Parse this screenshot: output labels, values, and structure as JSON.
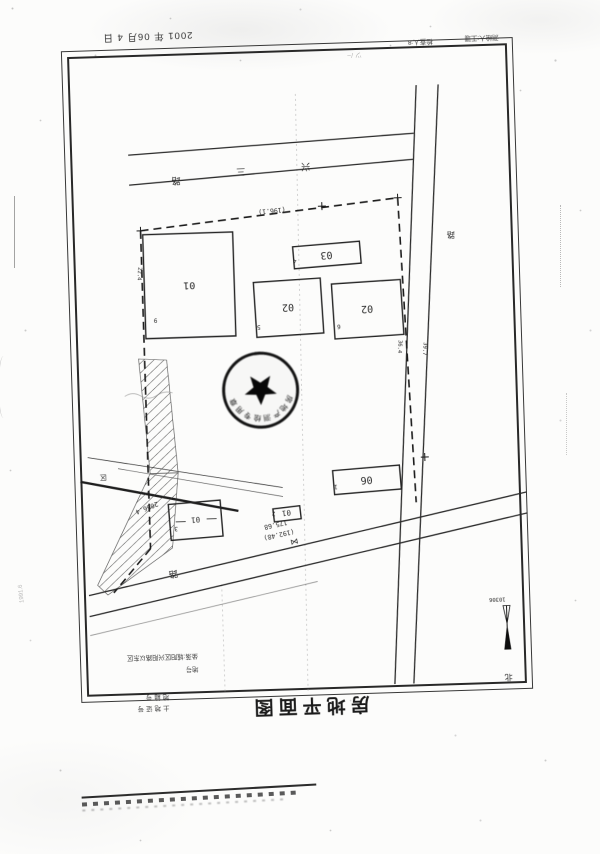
{
  "document": {
    "date_stamp": "2001 年 06月 4 日",
    "checker": "检查人:8",
    "surveyor": "测绘人:王珊",
    "title": "房地平面图",
    "corner_line1": "地籍号",
    "corner_line2": "土地证号",
    "pencil_note_left": "1991.6",
    "pencil_marks_top": "ツ /~"
  },
  "plan": {
    "roads": {
      "top_road_chars": [
        "路",
        "三",
        "兴"
      ],
      "bottom_road_char": "路",
      "side_road_char": "路",
      "road_width_dims": [
        "36.4",
        "39.7"
      ]
    },
    "buildings": [
      {
        "id": "01",
        "point": "9"
      },
      {
        "id": "02",
        "point": "5"
      },
      {
        "id": "02",
        "point": "6"
      },
      {
        "id": "03",
        "point": "4"
      },
      {
        "id": "06",
        "point": "1"
      },
      {
        "id": "01",
        "point": "2"
      },
      {
        "id": "01",
        "point": "3"
      }
    ],
    "dimensions": {
      "north_boundary": "(196.1)",
      "south_frontage": "175.68",
      "south_frontage_alt": "(192.48)",
      "west_dim": "2066.4",
      "building_side_dim": "22.4",
      "area_char": "区",
      "gate_symbol": "⋈"
    },
    "stamp": {
      "text": "房地产测绘专用章"
    },
    "legend": {
      "row1": "坐落:城阳区兴阳路以东区",
      "row2": "地号"
    },
    "north_indicator": {
      "sheet_no": "10306",
      "north_char": "北"
    }
  }
}
